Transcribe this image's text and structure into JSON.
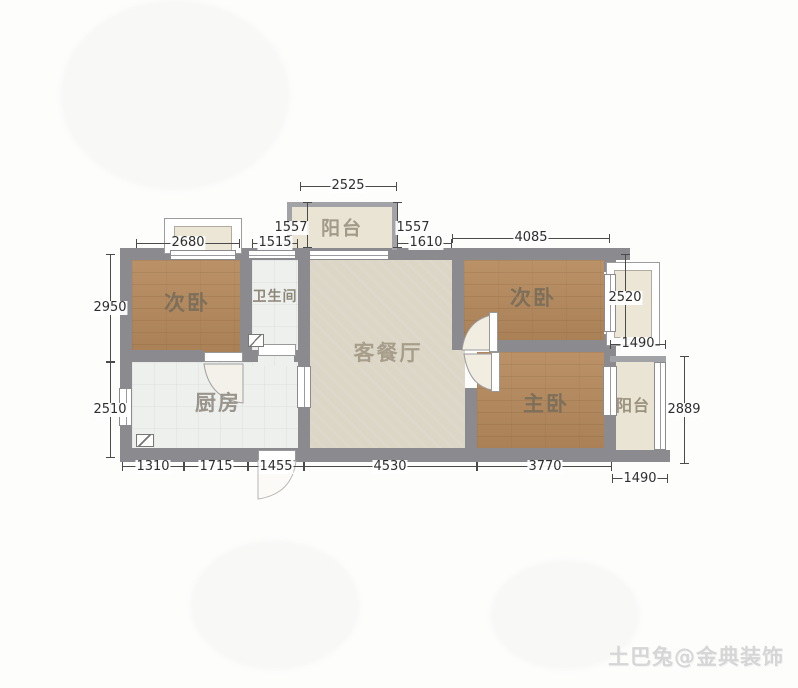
{
  "watermark": "土巴兔@金典装饰",
  "rooms": {
    "balcony_top": "阳台",
    "bedroom_left": "次卧",
    "bathroom": "卫生间",
    "living_dining": "客餐厅",
    "bedroom_right": "次卧",
    "kitchen": "厨房",
    "master_bedroom": "主卧",
    "balcony_right": "阳台"
  },
  "dimensions_mm": {
    "balcony_top_width": "2525",
    "balcony_top_depth_left": "1557",
    "balcony_top_depth_right": "1557",
    "bedroom_left_width": "2680",
    "bathroom_width": "1515",
    "living_top_width": "1610",
    "bedroom_right_width": "4085",
    "bedroom_left_height": "2950",
    "kitchen_height": "2510",
    "bay_right_height": "2520",
    "bay_right_width": "1490",
    "balcony_right_height": "2889",
    "bottom_seg_1": "1310",
    "bottom_seg_2": "1715",
    "bottom_seg_3": "1455",
    "bottom_seg_4": "4530",
    "bottom_seg_5": "3770",
    "balcony_right_bottom_width": "1490"
  },
  "colors": {
    "wall": "#8a8a8f",
    "wood_floor": "#b3895f",
    "living_floor": "#dcd6c7",
    "tile_floor": "#eef0ee",
    "balcony_floor": "#eae4d5",
    "dim_text": "#2e2e2e",
    "watermark_text": "#d6d6d6"
  }
}
